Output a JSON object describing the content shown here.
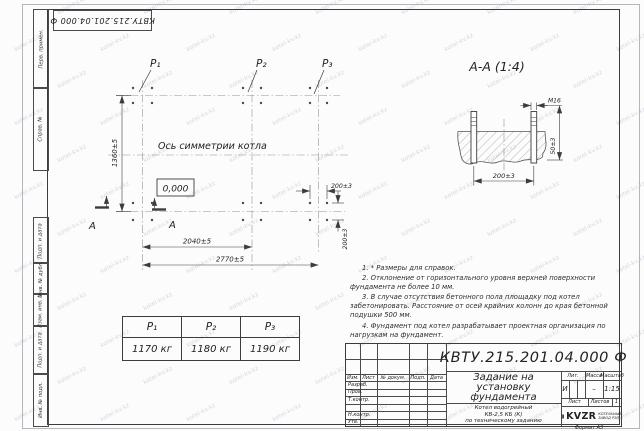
{
  "watermark": {
    "text": "kotel-kv.kz"
  },
  "stamp": {
    "doc_number": "КВТУ.215.201.04.000 Ф"
  },
  "plan": {
    "p_labels": [
      "P₁",
      "P₂",
      "P₃"
    ],
    "symmetry_text": "Ось симметрии котла",
    "elevation_mark": "0,000",
    "section_letter": "А",
    "dim_vertical": "1360±5",
    "dim_span_inner": "2040±5",
    "dim_span_outer": "2770±5",
    "dim_right_horizontal": "200±3",
    "dim_right_vertical": "200±3"
  },
  "section": {
    "title": "А-А (1:4)",
    "thread_label": "М16",
    "dim_bolt_spacing": "200±3",
    "dim_protrusion": "50±3"
  },
  "load_table": {
    "headers": [
      "P₁",
      "P₂",
      "P₃"
    ],
    "values": [
      "1170 кг",
      "1180 кг",
      "1190 кг"
    ]
  },
  "notes": {
    "items": [
      "1. * Размеры для справок.",
      "2. Отклонение от горизонтального уровня верхней поверхности фундамента не более 10 мм.",
      "3. В случае отсутствия бетонного пола площадку под котел забетонировать. Расстояние от осей крайних колонн до края бетонной подушки 500 мм.",
      "4. Фундамент под котел разрабатывает проектная организация по нагрузкам на фундамент."
    ]
  },
  "title_block": {
    "doc_number": "КВТУ.215.201.04.000 Ф",
    "title_lines": [
      "Задание на",
      "установку",
      "фундамента"
    ],
    "product_lines": [
      "Котел водогрейный",
      "КВ-2,5 КБ (К)",
      "по техническому заданию"
    ],
    "header_cells": [
      "Изм.",
      "Лист",
      "№ докум.",
      "Подп.",
      "Дата"
    ],
    "staff_rows": [
      "Разраб.",
      "Пров.",
      "Т.контр.",
      "",
      "Н.контр.",
      "Утв."
    ],
    "lit_label": "Лит.",
    "lit_value": "И",
    "mass_label": "Масса",
    "mass_value": "–",
    "scale_label": "Масштаб",
    "scale_value": "1:15",
    "sheet_label": "Лист",
    "sheets_label": "Листов",
    "sheets_value": "1",
    "logo_text": "KVZR",
    "logo_caption_lines": [
      "КОТЕЛЬНЫЙ",
      "ЗАВОД РЭП"
    ],
    "format_label": "Формат А3"
  },
  "side_strip": {
    "top": [
      "Перв. примен.",
      "Справ. №"
    ],
    "bottom": [
      "Подп. и дата",
      "Инв. № дубл.",
      "Взам. инв. №",
      "Подп. и дата",
      "Инв. № подл."
    ]
  }
}
